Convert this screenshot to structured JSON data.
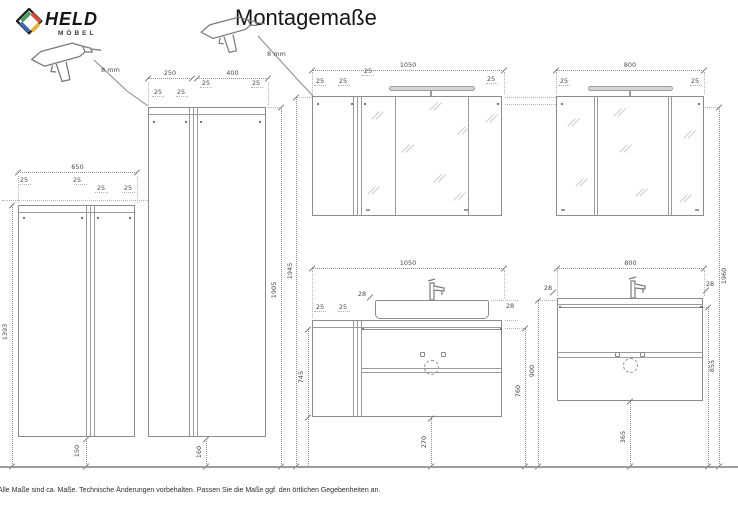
{
  "header": {
    "logo_text": "HELD",
    "logo_sub": "MÖBEL",
    "title": "Montagemaße"
  },
  "logo_colors": {
    "outline": "#222222",
    "green": "#43a05f",
    "red": "#d34f3c",
    "yellow": "#e6b33c",
    "blue": "#3d6ab0"
  },
  "drill": {
    "hole1": "8 mm",
    "hole2": "8 mm"
  },
  "dims": {
    "c650": {
      "w": "650",
      "i1": "25",
      "i2": "25",
      "i3": "25",
      "i4": "25",
      "h": "1393",
      "gap": "150"
    },
    "c250400": {
      "w1": "250",
      "w2": "400",
      "i1": "25",
      "i2": "25",
      "i3": "25",
      "i4": "25",
      "h": "1905",
      "gap": "160"
    },
    "m1050": {
      "w": "1050",
      "i1": "25",
      "i2": "25",
      "i3": "25",
      "i4": "25",
      "h": "1945"
    },
    "m800": {
      "w": "800",
      "i1": "25",
      "i2": "25",
      "h": "1960"
    },
    "v1050": {
      "w": "1050",
      "i1": "25",
      "i2": "25",
      "t1": "28",
      "t2": "28",
      "h": "745",
      "floor": "760",
      "gap": "270"
    },
    "v800": {
      "w": "800",
      "t1": "28",
      "t2": "28",
      "floor": "900",
      "side": "855",
      "gap": "365"
    }
  },
  "footer": {
    "note": "Alle Maße sind ca. Maße. Technische Änderungen vorbehalten. Passen Sie die Maße ggf. den örtlichen Gegebenheiten an."
  }
}
